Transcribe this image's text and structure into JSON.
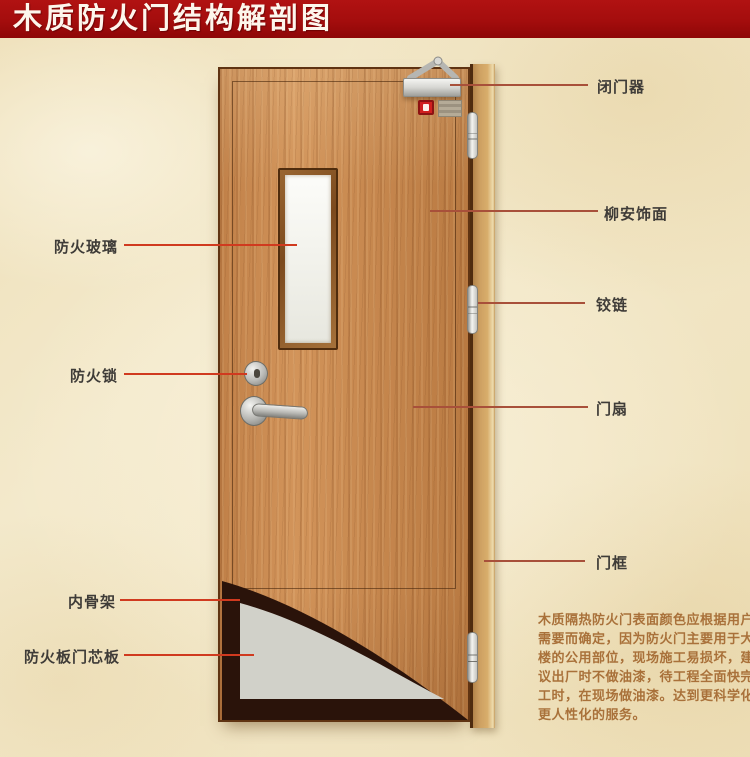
{
  "title": "木质防火门结构解剖图",
  "callouts": {
    "right": [
      {
        "label": "闭门器"
      },
      {
        "label": "柳安饰面"
      },
      {
        "label": "铰链"
      },
      {
        "label": "门扇"
      },
      {
        "label": "门框"
      }
    ],
    "left": [
      {
        "label": "防火玻璃"
      },
      {
        "label": "防火锁"
      },
      {
        "label": "内骨架"
      },
      {
        "label": "防火板门芯板"
      }
    ]
  },
  "description": {
    "lines": [
      "木质隔热防火门表面颜色应根据用户",
      "需要而确定，因为防火门主要用于大",
      "楼的公用部位，现场施工易损坏，建",
      "议出厂时不做油漆，待工程全面快完",
      "工时，在现场做油漆。达到更科学化",
      "更人性化的服务。"
    ]
  },
  "colors": {
    "banner_red": "#a40d0d",
    "background_cream": "#f2e7c7",
    "door_wood": "#c6874e",
    "frame_wood": "#d9ae6c",
    "core_panel_grey": "#d1d1c9",
    "skeleton_dark": "#2a130a",
    "callout_line_left": "#d03a1f",
    "callout_line_right": "#a8503a",
    "label_text": "#3f3c38",
    "description_text": "#a9713a"
  }
}
